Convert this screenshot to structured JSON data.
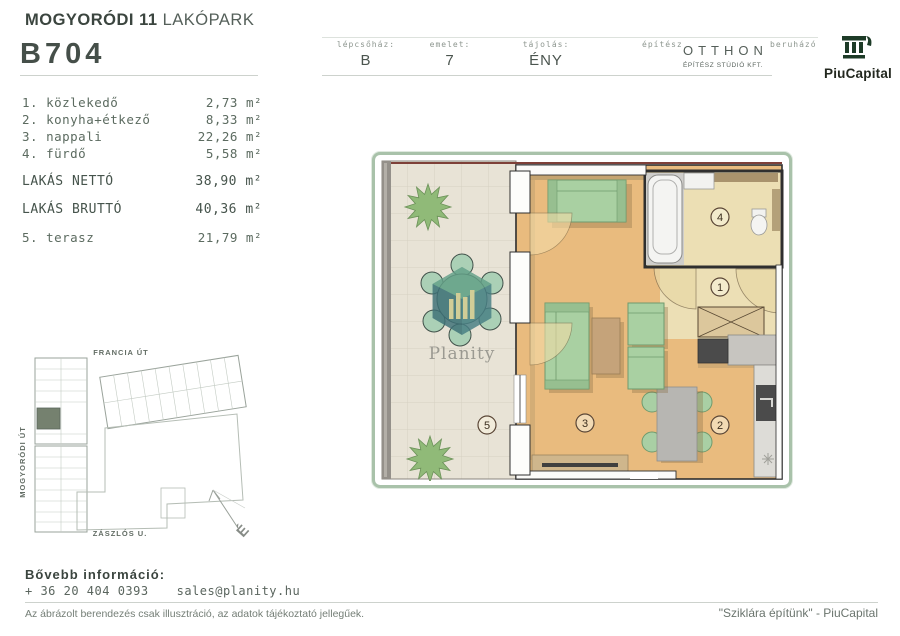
{
  "header": {
    "project_bold": "MOGYORÓDI 11",
    "project_rest": " LAKÓPARK",
    "unit_code": "B704",
    "fields": [
      {
        "label": "lépcsőház:",
        "value": "B"
      },
      {
        "label": "emelet:",
        "value": "7"
      },
      {
        "label": "tájolás:",
        "value": "ÉNY"
      }
    ],
    "architect_label": "építész",
    "architect_name": "OTTHON",
    "architect_sub": "ÉPÍTÉSZ STÚDIÓ KFT.",
    "developer_label": "beruházó",
    "developer_name": "PiuCapital"
  },
  "rooms": {
    "items": [
      {
        "name": "1. közlekedő",
        "area": "2,73 m²"
      },
      {
        "name": "2. konyha+étkező",
        "area": "8,33 m²"
      },
      {
        "name": "3. nappali",
        "area": "22,26 m²"
      },
      {
        "name": "4. fürdő",
        "area": "5,58 m²"
      }
    ],
    "net_label": "LAKÁS NETTÓ",
    "net_area": "38,90 m²",
    "gross_label": "LAKÁS BRUTTÓ",
    "gross_area": "40,36 m²",
    "terrace_label": "5. terasz",
    "terrace_area": "21,79 m²"
  },
  "site_map": {
    "street_top": "FRANCIA ÚT",
    "street_left": "MOGYORÓDI ÚT",
    "street_bottom": "ZÁSZLÓS U.",
    "compass": "É"
  },
  "floor_plan": {
    "markers": [
      "1",
      "2",
      "3",
      "4",
      "5"
    ],
    "watermark": "Planity"
  },
  "footer": {
    "info_label": "Bővebb információ:",
    "phone": "+ 36 20 404 0393",
    "email": "sales@planity.hu",
    "disclaimer": "Az ábrázolt berendezés csak illusztráció, az adatok tájékoztató jellegűek.",
    "quote": "\"Sziklára építünk\" - PiuCapital"
  },
  "colors": {
    "accent_green": "#a9c2aa",
    "wood_floor": "#e9bb7e",
    "terrace_tile": "#e8e3d6",
    "furniture_green": "#a9d0a2",
    "watermark_teal": "#477f84",
    "logo_green": "#1d3b27"
  }
}
